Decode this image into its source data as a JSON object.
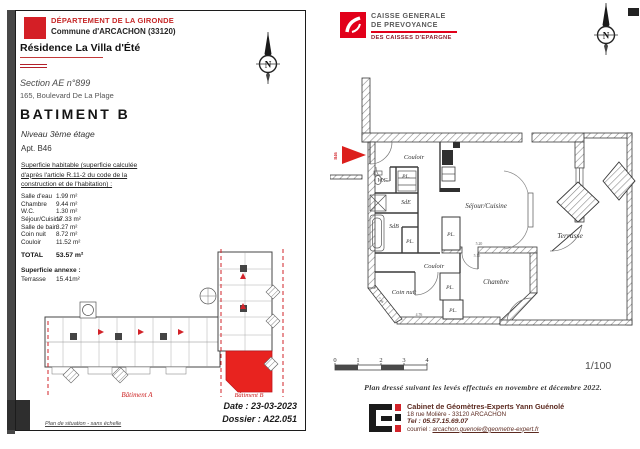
{
  "colors": {
    "accent_red": "#d2232a",
    "plan_red": "#e8231f",
    "caisse_red": "#e2001a"
  },
  "left_panel": {
    "department": "DÉPARTEMENT DE LA GIRONDE",
    "commune": "Commune d'ARCACHON (33120)",
    "residence": "Résidence La Villa d'Été",
    "section": "Section AE n°899",
    "address": "165, Boulevard De La Plage",
    "building": "BATIMENT B",
    "level": "Niveau 3ème étage",
    "apartment": "Apt. B46",
    "note_line1": "Superficie habitable (superficie calculée",
    "note_line2": "d'après l'article R.11-2 du code de la",
    "note_line3": "construction et de l'habitation) :",
    "surface_table": {
      "rows": [
        {
          "label": "Salle d'eau",
          "value": "1.99 m²"
        },
        {
          "label": "Chambre",
          "value": "9.44 m²"
        },
        {
          "label": "W.C.",
          "value": "1.30 m²"
        },
        {
          "label": "Séjour/Cuisine",
          "value": "17.33 m²"
        },
        {
          "label": "Salle de bain",
          "value": "3.27 m²"
        },
        {
          "label": "Coin nuit",
          "value": "8.72 m²"
        },
        {
          "label": "Couloir",
          "value": "11.52 m²"
        }
      ],
      "total_label": "TOTAL",
      "total_value": "53.57 m²"
    },
    "annex_title": "Superficie annexe :",
    "annex_label": "Terrasse",
    "annex_value": "15.41m²",
    "situation": {
      "batiment_a": "Bâtiment A",
      "batiment_b": "Bâtiment B",
      "caption": "Plan de situation - sans échelle"
    },
    "date": "Date : 23-03-2023",
    "dossier": "Dossier : A22.051"
  },
  "right_panel": {
    "caisse": {
      "line1": "CAISSE GENERALE",
      "line2": "DE PREVOYANCE",
      "line3": "DES CAISSES D'EPARGNE"
    },
    "compass_letter": "N",
    "floor_plan": {
      "entry": "B46",
      "rooms": {
        "couloir_upper": "Couloir",
        "wc": "W.C.",
        "pl": "PL.",
        "sde": "SdE",
        "sdb": "SdB",
        "sejour": "Séjour/Cuisine",
        "couloir_lower": "Couloir",
        "coin_nuit": "Coin nuit",
        "chambre": "Chambre",
        "terrasse": "Terrasse"
      },
      "dims": {
        "d1": "5.20",
        "d2": "5.15",
        "d3": "7.46",
        "d4": "4.76"
      }
    },
    "scale": {
      "t0": "0",
      "t1": "1",
      "t2": "2",
      "t3": "3",
      "t4": "4",
      "ratio": "1/100"
    },
    "survey_note": "Plan dressé suivant les levés effectués en novembre et décembre 2022.",
    "cabinet": {
      "name": "Cabinet de Géomètres-Experts Yann Guénolé",
      "address": "18 rue Molière - 33120 ARCACHON",
      "tel": "Tel : 05.57.15.69.07",
      "email_label": "courriel : ",
      "email": "arcachon.guenole@geometre-expert.fr"
    }
  }
}
